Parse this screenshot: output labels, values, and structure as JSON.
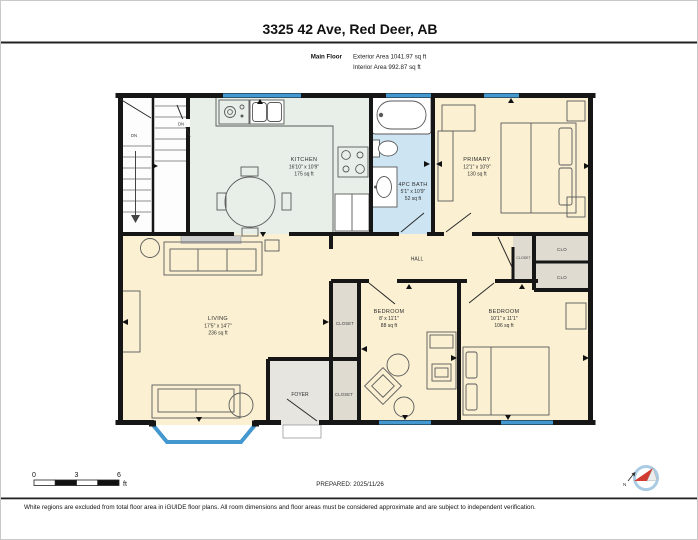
{
  "header": {
    "title": "3325 42 Ave, Red Deer, AB",
    "floor_label": "Main Floor",
    "exterior_area": "Exterior Area 1041.97 sq ft",
    "interior_area": "Interior Area 992.87 sq ft"
  },
  "rooms": {
    "kitchen": {
      "name": "KITCHEN",
      "dims": "16'10\" x 10'9\"",
      "area": "175 sq ft"
    },
    "bath": {
      "name": "4PC BATH",
      "dims": "5'1\" x 10'9\"",
      "area": "52 sq ft"
    },
    "primary": {
      "name": "PRIMARY",
      "dims": "12'1\" x 10'9\"",
      "area": "130 sq ft"
    },
    "living": {
      "name": "LIVING",
      "dims": "17'5\" x 14'7\"",
      "area": "236 sq ft"
    },
    "bedroom1": {
      "name": "BEDROOM",
      "dims": "8' x 11'1\"",
      "area": "88 sq ft"
    },
    "bedroom2": {
      "name": "BEDROOM",
      "dims": "10'1\" x 11'1\"",
      "area": "106 sq ft"
    },
    "hall": {
      "name": "HALL"
    },
    "foyer": {
      "name": "FOYER"
    },
    "closet_bedroom1": {
      "name": "CLOSET"
    },
    "closet_foyer": {
      "name": "CLOSET"
    },
    "closet_hall": {
      "name": "CLOSET"
    },
    "clo_top": {
      "name": "CLO"
    },
    "clo_bottom": {
      "name": "CLO"
    },
    "stair_down_left": "DN",
    "stair_down_right": "DN"
  },
  "scale_bar": {
    "tick_0": "0",
    "tick_3": "3",
    "tick_6": "6",
    "unit": "ft"
  },
  "prepared_label": "PREPARED: 2025/11/26",
  "compass": {
    "north_label": "N"
  },
  "footer_disclaimer": "White regions are excluded from total floor area in iGUIDE floor plans. All room dimensions and floor areas must be considered approximate and are subject to independent verification.",
  "colors": {
    "room_cream": "#fbf0d2",
    "kitchen_mint": "#e7efe8",
    "bath_blue": "#cde5f3",
    "closet_gray": "#dfdbd1",
    "foyer_gray": "#e7e5e0",
    "stairs_white": "#fdfdfd",
    "window_blue": "#4398cf",
    "wall_black": "#161616",
    "compass_red": "#d23b30"
  }
}
